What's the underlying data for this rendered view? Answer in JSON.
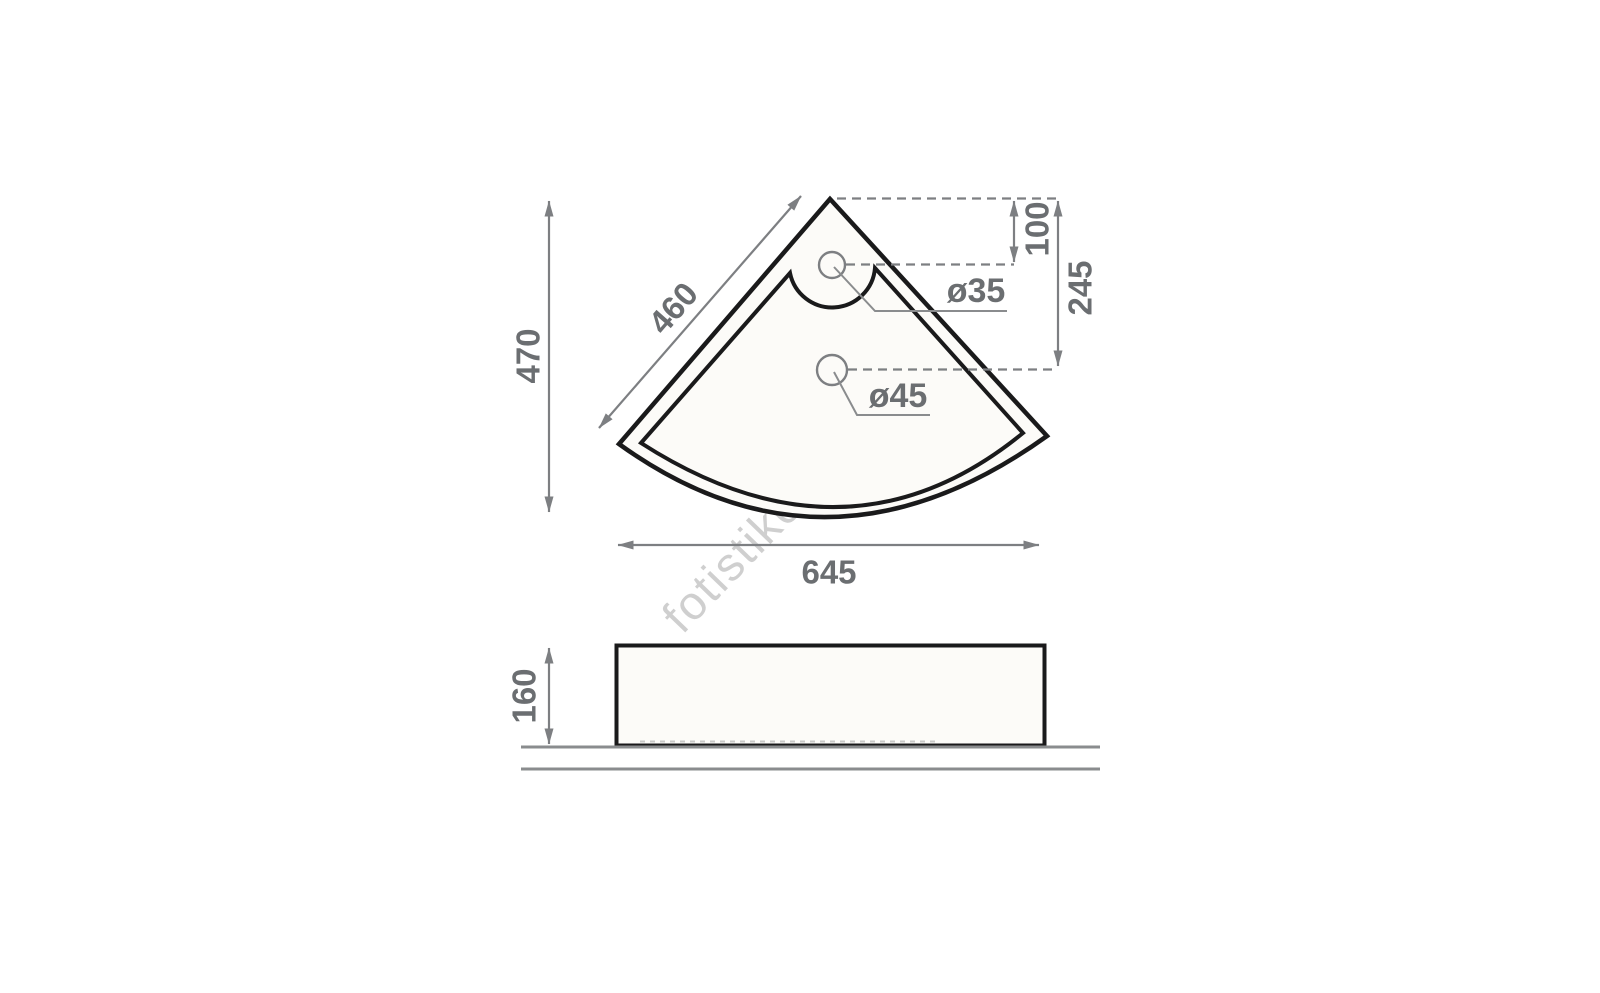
{
  "drawing": {
    "watermark": "fotistikosmos.gr",
    "top_view": {
      "overall_height_label": "470",
      "side_edge_label": "460",
      "overall_width_label": "645",
      "faucet_offset_label": "100",
      "drain_offset_label": "245",
      "faucet_hole_label": "ø35",
      "drain_hole_label": "ø45"
    },
    "side_view": {
      "height_label": "160"
    },
    "colors": {
      "outline": "#1a1a1b",
      "dimension_line": "#7d7f82",
      "dimension_text": "#6b6e71",
      "watermark": "#c4c4c4",
      "basin_fill": "#fcfbf8"
    }
  }
}
